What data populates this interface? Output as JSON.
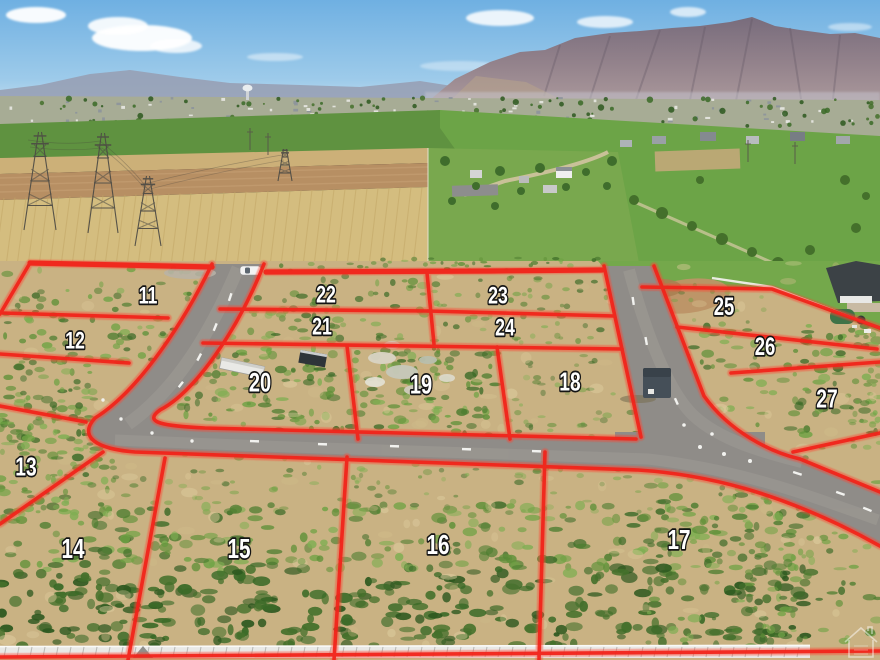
{
  "image": {
    "kind": "aerial-drone-photo",
    "subject": "subdivision lots for sale outlined in red over graded land, farmland and mountain backdrop"
  },
  "overlay": {
    "line_color": "#f2231a",
    "label_color": "#ffffff",
    "label_outline": "#141414"
  },
  "lots": [
    {
      "label": "11",
      "x": 148,
      "y": 295,
      "fs": 24
    },
    {
      "label": "12",
      "x": 75,
      "y": 340,
      "fs": 24
    },
    {
      "label": "22",
      "x": 326,
      "y": 294,
      "fs": 24
    },
    {
      "label": "21",
      "x": 322,
      "y": 326,
      "fs": 24
    },
    {
      "label": "23",
      "x": 498,
      "y": 295,
      "fs": 24
    },
    {
      "label": "24",
      "x": 505,
      "y": 327,
      "fs": 24
    },
    {
      "label": "25",
      "x": 724,
      "y": 306,
      "fs": 25
    },
    {
      "label": "26",
      "x": 765,
      "y": 346,
      "fs": 25
    },
    {
      "label": "27",
      "x": 827,
      "y": 398,
      "fs": 26
    },
    {
      "label": "20",
      "x": 260,
      "y": 382,
      "fs": 27
    },
    {
      "label": "19",
      "x": 421,
      "y": 384,
      "fs": 27
    },
    {
      "label": "18",
      "x": 570,
      "y": 381,
      "fs": 26
    },
    {
      "label": "13",
      "x": 26,
      "y": 466,
      "fs": 26
    },
    {
      "label": "14",
      "x": 73,
      "y": 548,
      "fs": 28
    },
    {
      "label": "15",
      "x": 239,
      "y": 548,
      "fs": 28
    },
    {
      "label": "16",
      "x": 438,
      "y": 544,
      "fs": 28
    },
    {
      "label": "17",
      "x": 679,
      "y": 539,
      "fs": 28
    }
  ],
  "watermark": {
    "icon": "house-logo-watermark"
  }
}
